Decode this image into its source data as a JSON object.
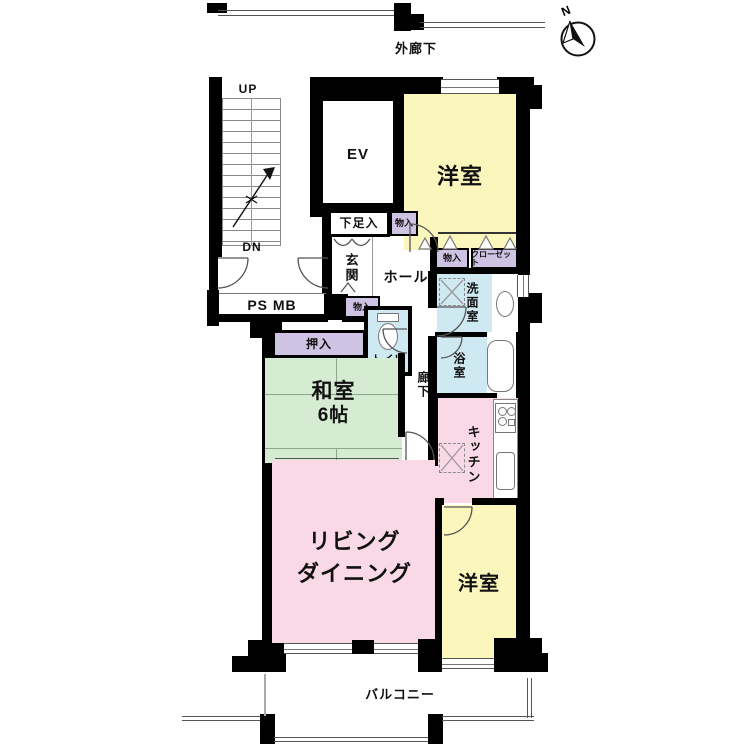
{
  "compass": {
    "north_label": "N"
  },
  "labels": {
    "outer_corridor": "外廊下",
    "up": "UP",
    "dn": "DN",
    "ps_mb": "PS MB",
    "ev": "EV",
    "bedroom_top": "洋室",
    "shoe_cabinet": "下足入",
    "storage_entry": "物入",
    "entrance": "玄関",
    "hall": "ホール",
    "storage_hall": "物入",
    "storage_wet": "物入",
    "closet": "クローゼット",
    "washroom": "洗面室",
    "bathroom": "浴室",
    "toilet": "トイレ",
    "oshiire": "押入",
    "japanese_room_name": "和室",
    "japanese_room_size": "6帖",
    "corridor": "廊下",
    "kitchen": "キッチン",
    "living_line1": "リビング",
    "living_line2": "ダイニング",
    "bedroom_bottom": "洋室",
    "balcony": "バルコニー"
  },
  "colors": {
    "bedroom": "#faf6bc",
    "japanese_room": "#d5ecd2",
    "living_dining": "#f9d9e6",
    "closet": "#cfc3e4",
    "wet_area": "#cfe9f2",
    "wall": "#000000"
  }
}
